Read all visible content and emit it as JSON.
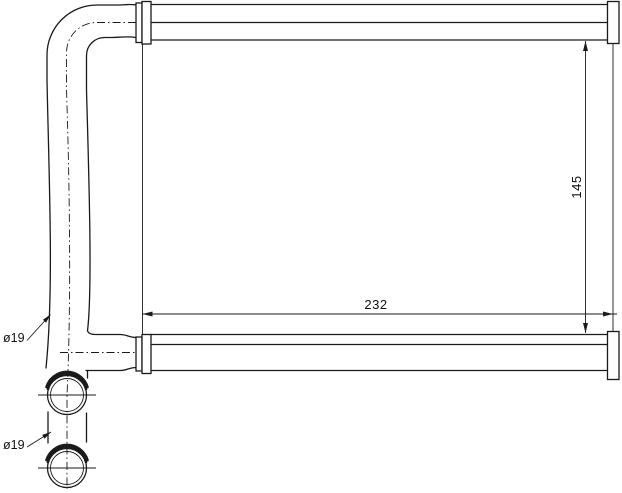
{
  "drawing": {
    "background_color": "#ffffff",
    "line_color": "#1a1a1a",
    "dimensions": {
      "core_width": "232",
      "core_height": "145",
      "inlet_pipe_diameter": "ø19",
      "outlet_pipe_diameter": "ø19"
    }
  }
}
